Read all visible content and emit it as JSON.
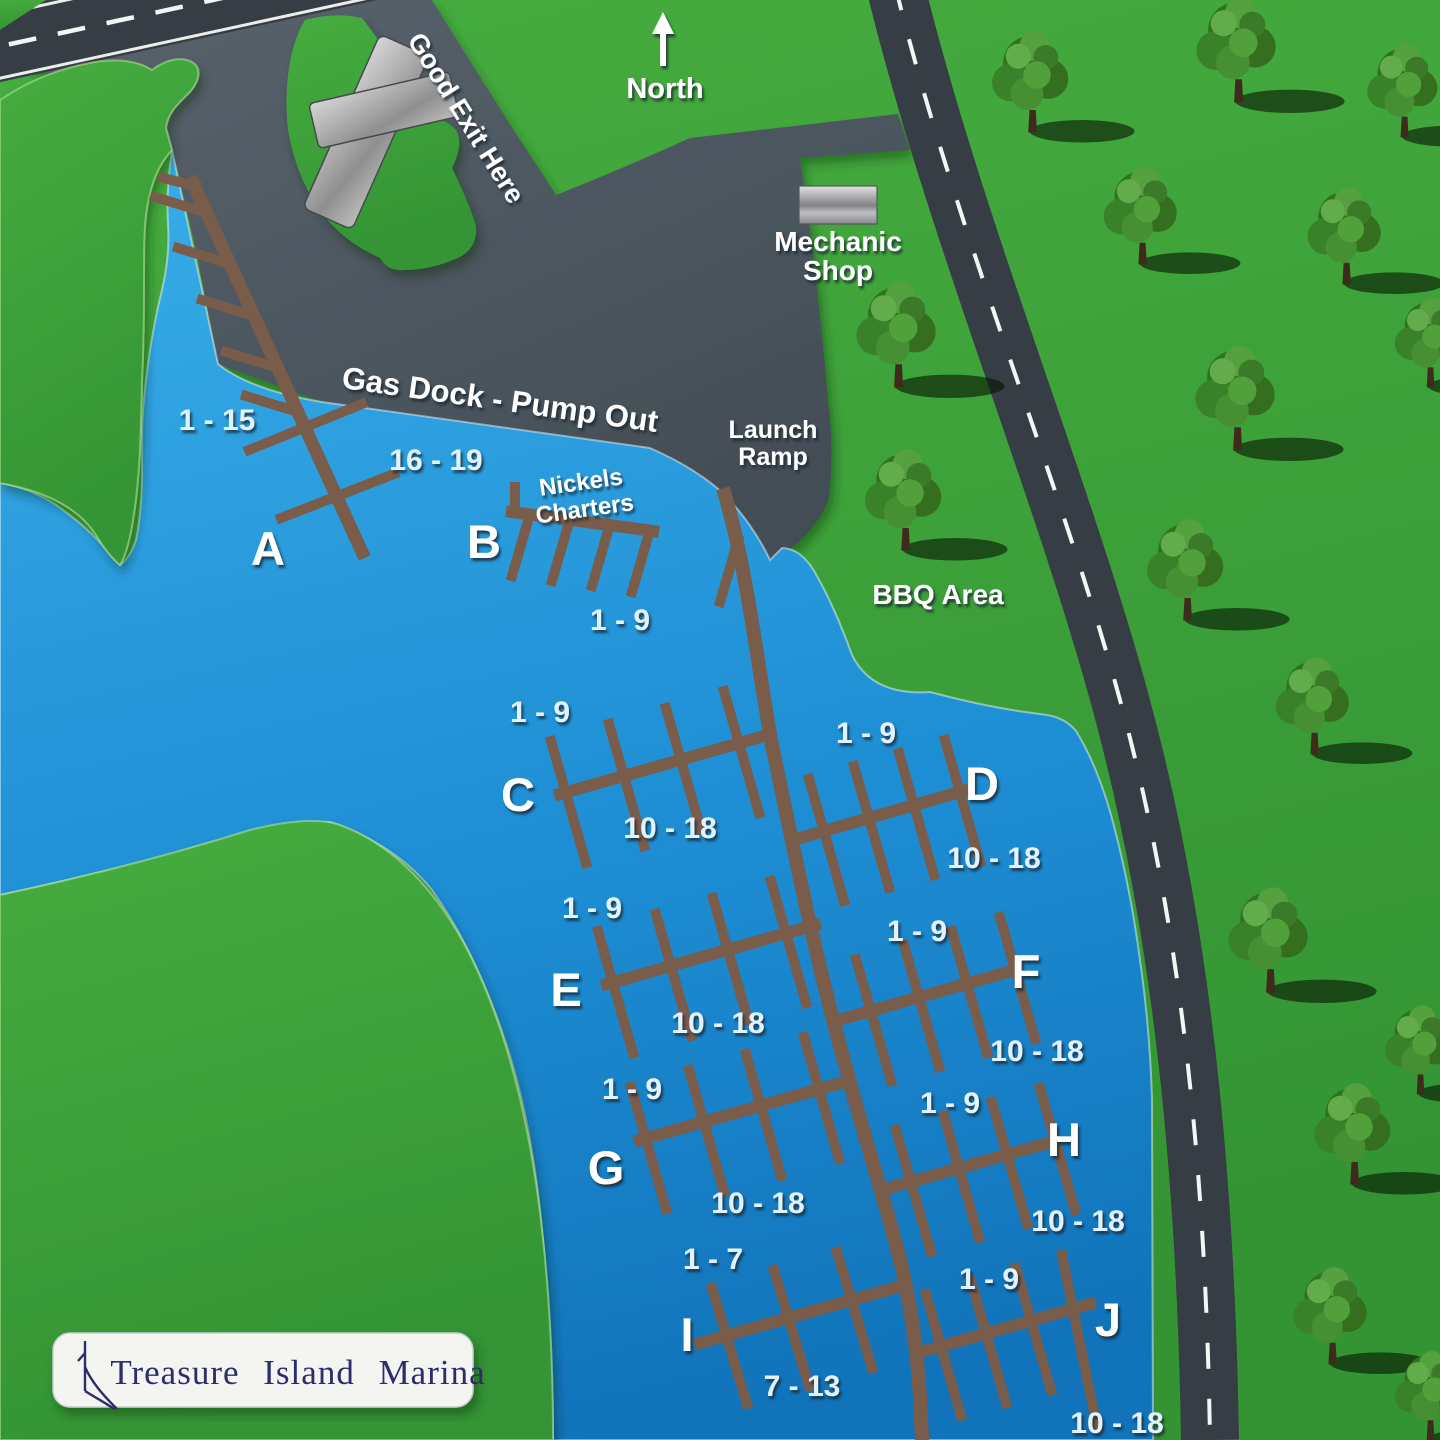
{
  "map_title": "Treasure Island Marina",
  "compass": {
    "label": "North"
  },
  "areas": {
    "good_exit": "Good Exit Here",
    "gas_dock": "Gas Dock - Pump Out",
    "mechanic_shop": [
      "Mechanic",
      "Shop"
    ],
    "launch_ramp": [
      "Launch",
      "Ramp"
    ],
    "nickels_charters": [
      "Nickels",
      "Charters"
    ],
    "bbq": "BBQ Area"
  },
  "docks": [
    {
      "id": "A",
      "slip_ranges": [
        "1 - 15",
        "16 - 19"
      ]
    },
    {
      "id": "B",
      "slip_ranges": [
        "1 - 9"
      ]
    },
    {
      "id": "C",
      "slip_ranges": [
        "1 - 9",
        "10 - 18"
      ]
    },
    {
      "id": "D",
      "slip_ranges": [
        "1 - 9",
        "10 - 18"
      ]
    },
    {
      "id": "E",
      "slip_ranges": [
        "1 - 9",
        "10 - 18"
      ]
    },
    {
      "id": "F",
      "slip_ranges": [
        "1 - 9",
        "10 - 18"
      ]
    },
    {
      "id": "G",
      "slip_ranges": [
        "1 - 9",
        "10 - 18"
      ]
    },
    {
      "id": "H",
      "slip_ranges": [
        "1 - 9",
        "10 - 18"
      ]
    },
    {
      "id": "I",
      "slip_ranges": [
        "1 - 7",
        "7 - 13"
      ]
    },
    {
      "id": "J",
      "slip_ranges": [
        "1 - 9",
        "10 - 18"
      ]
    }
  ],
  "logo": {
    "text": "Treasure Island Marina",
    "icon": "sailboat-icon"
  },
  "colors": {
    "water": "#1E8ED4",
    "land": "#3CA238",
    "pavement": "#4C565E",
    "road": "#363D44",
    "road_line": "#FFFFFF",
    "dock": "#7A5C4A",
    "building": "#AFAFAF",
    "label_text": "#FFFFFF",
    "slip_text": "#E2F3FF",
    "logo_text": "#2D2D6E",
    "logo_bg": "#F4F4F1"
  }
}
